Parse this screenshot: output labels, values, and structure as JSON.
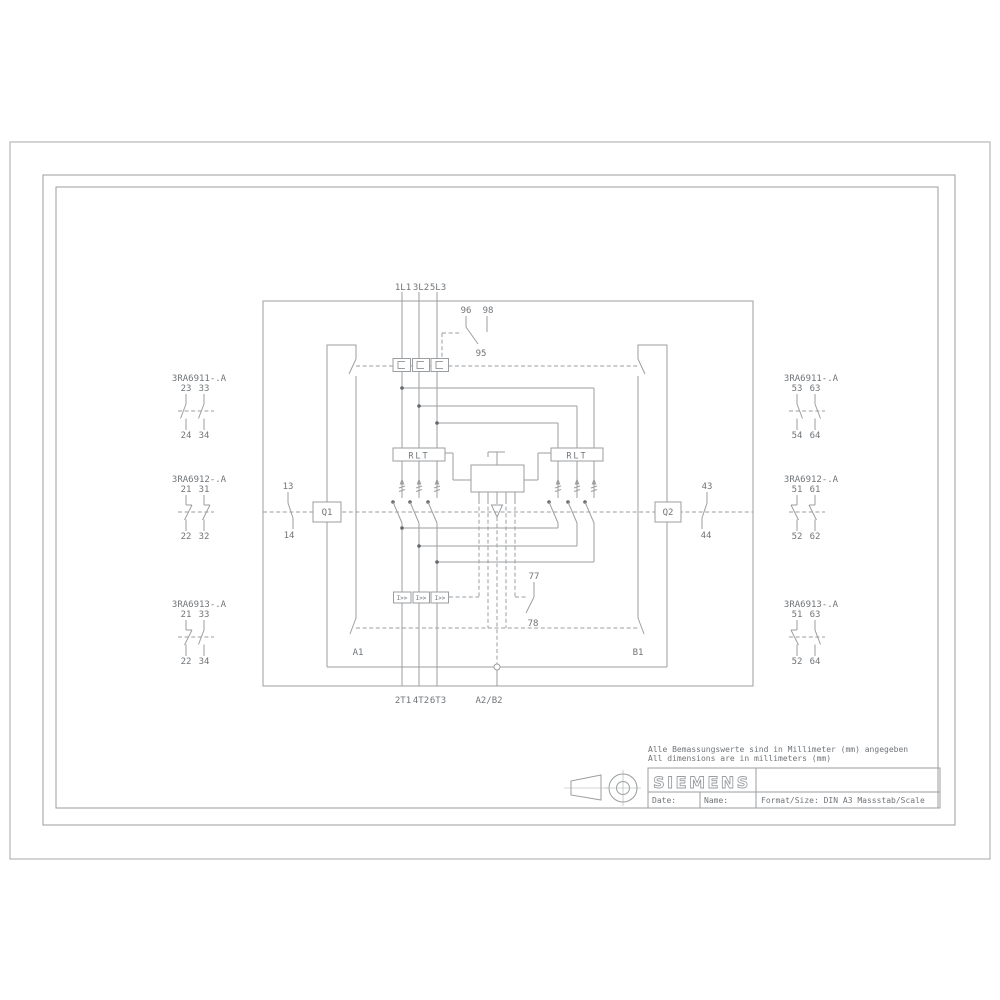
{
  "colors": {
    "line": "#9b9ea1",
    "text": "#707478",
    "frame": "#b3b6b8"
  },
  "terminals": {
    "top": [
      "1L1",
      "3L2",
      "5L3"
    ],
    "bottom": [
      "2T1",
      "4T2",
      "6T3"
    ],
    "coil": "A2/B2"
  },
  "overload": {
    "t96": "96",
    "t98": "98",
    "t95": "95"
  },
  "sensors": {
    "left": "RLT",
    "right": "RLT"
  },
  "trip_label": "I>>",
  "q1": {
    "label": "Q1",
    "top": "13",
    "bottom": "14"
  },
  "q2": {
    "label": "Q2",
    "top": "43",
    "bottom": "44"
  },
  "mech": {
    "left": "A1",
    "right": "B1",
    "aux_top": "77",
    "aux_bottom": "78"
  },
  "aux_blocks": {
    "left": [
      {
        "name": "3RA6911-.A",
        "t1": "23",
        "t2": "33",
        "b1": "24",
        "b2": "34"
      },
      {
        "name": "3RA6912-.A",
        "t1": "21",
        "t2": "31",
        "b1": "22",
        "b2": "32"
      },
      {
        "name": "3RA6913-.A",
        "t1": "21",
        "t2": "33",
        "b1": "22",
        "b2": "34"
      }
    ],
    "right": [
      {
        "name": "3RA6911-.A",
        "t1": "53",
        "t2": "63",
        "b1": "54",
        "b2": "64"
      },
      {
        "name": "3RA6912-.A",
        "t1": "51",
        "t2": "61",
        "b1": "52",
        "b2": "62"
      },
      {
        "name": "3RA6913-.A",
        "t1": "51",
        "t2": "63",
        "b1": "52",
        "b2": "64"
      }
    ]
  },
  "title_block": {
    "note_de": "Alle Bemassungswerte sind in Millimeter (mm) angegeben",
    "note_en": "All dimensions are in millimeters (mm)",
    "brand": "SIEMENS",
    "date_label": "Date:",
    "name_label": "Name:",
    "format_label": "Format/Size: DIN A3 Massstab/Scale"
  }
}
